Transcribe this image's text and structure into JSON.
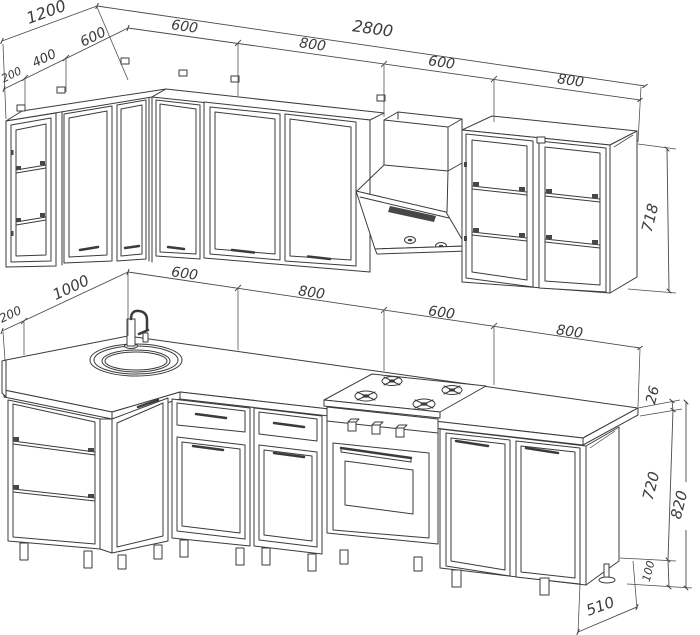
{
  "background": "#ffffff",
  "line_color": "#3b3b3b",
  "text_color": "#3a3a3a",
  "drawing_type": "kitchen-cabinet-technical-drawing",
  "dims": {
    "upper": {
      "left_total": "1200",
      "left_seg_200": "200",
      "left_seg_400": "400",
      "left_seg_600": "600",
      "back_total": "2800",
      "back_seg_1": "600",
      "back_seg_2": "800",
      "back_seg_3": "600",
      "back_seg_4": "800",
      "cabinet_height": "718"
    },
    "lower": {
      "left_end": "200",
      "left_length": "1000",
      "back_seg_1": "600",
      "back_seg_2": "800",
      "back_seg_3": "600",
      "back_seg_4": "800",
      "countertop_thickness": "26",
      "body_height": "720",
      "total_height": "820",
      "plinth_height": "100",
      "base_depth": "510"
    }
  }
}
